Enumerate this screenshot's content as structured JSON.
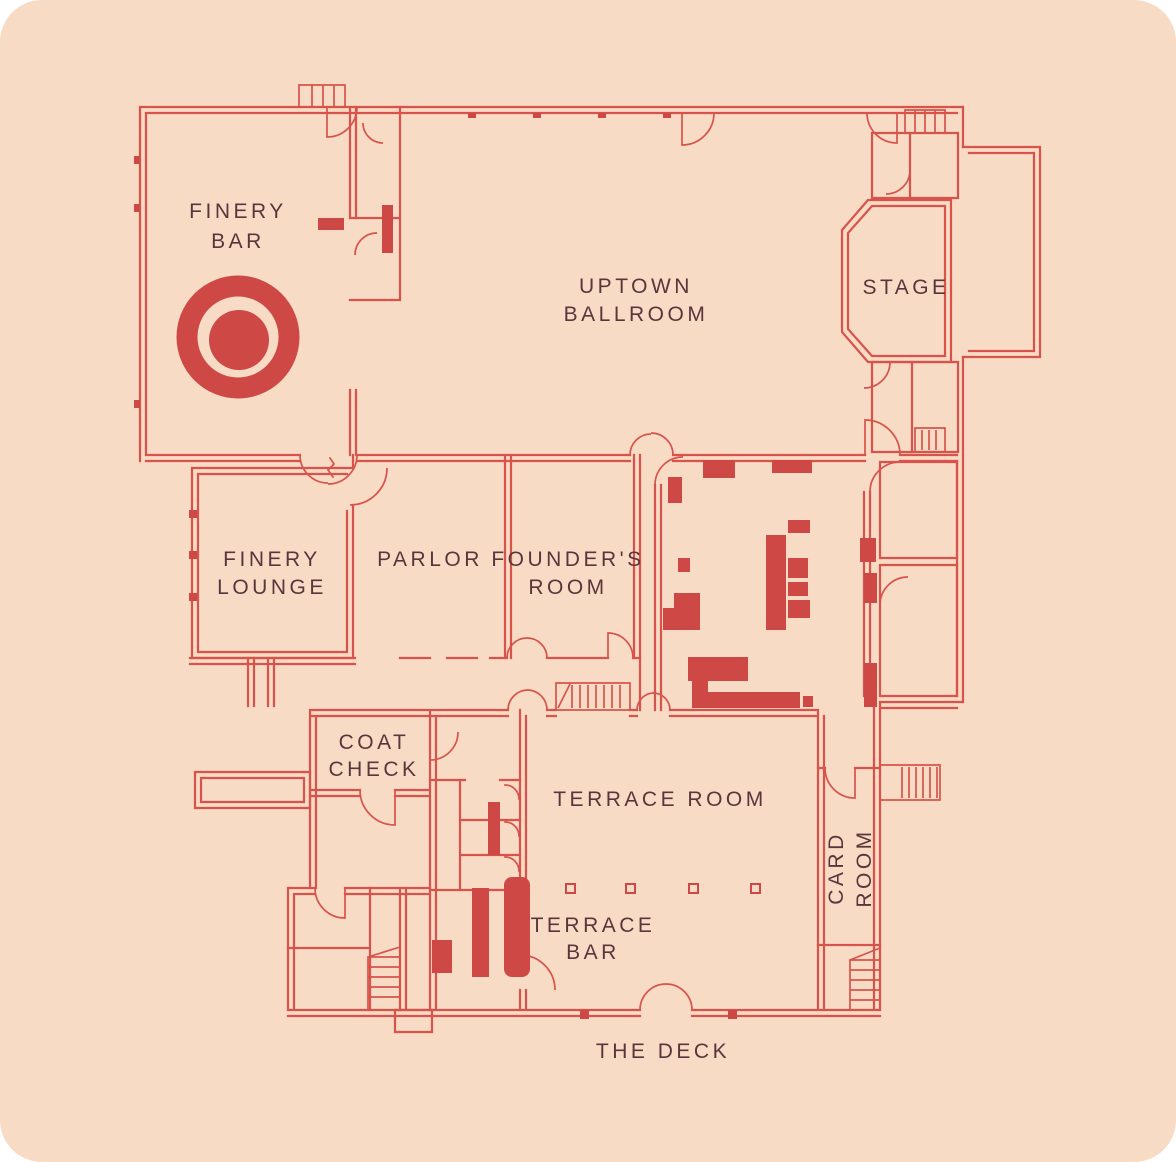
{
  "palette": {
    "canvas_background": "#FFFFFF",
    "plan_background": "#F7DBC5",
    "wall_line": "#D8534B",
    "fixture_fill": "#CE4845",
    "label_text": "#5A363C"
  },
  "labels": {
    "finery_bar": {
      "line1": "FINERY",
      "line2": "BAR"
    },
    "uptown_ballroom": {
      "line1": "UPTOWN",
      "line2": "BALLROOM"
    },
    "stage": {
      "line1": "STAGE"
    },
    "finery_lounge": {
      "line1": "FINERY",
      "line2": "LOUNGE"
    },
    "parlor": {
      "line1": "PARLOR"
    },
    "founders_room": {
      "line1": "FOUNDER'S",
      "line2": "ROOM"
    },
    "coat_check": {
      "line1": "COAT",
      "line2": "CHECK"
    },
    "terrace_room": {
      "line1": "TERRACE ROOM"
    },
    "terrace_bar": {
      "line1": "TERRACE",
      "line2": "BAR"
    },
    "card_room": {
      "line1": "CARD",
      "line2": "ROOM"
    },
    "the_deck": {
      "line1": "THE DECK"
    }
  },
  "icons": {
    "bullseye": "target-marker in Finery Bar"
  }
}
